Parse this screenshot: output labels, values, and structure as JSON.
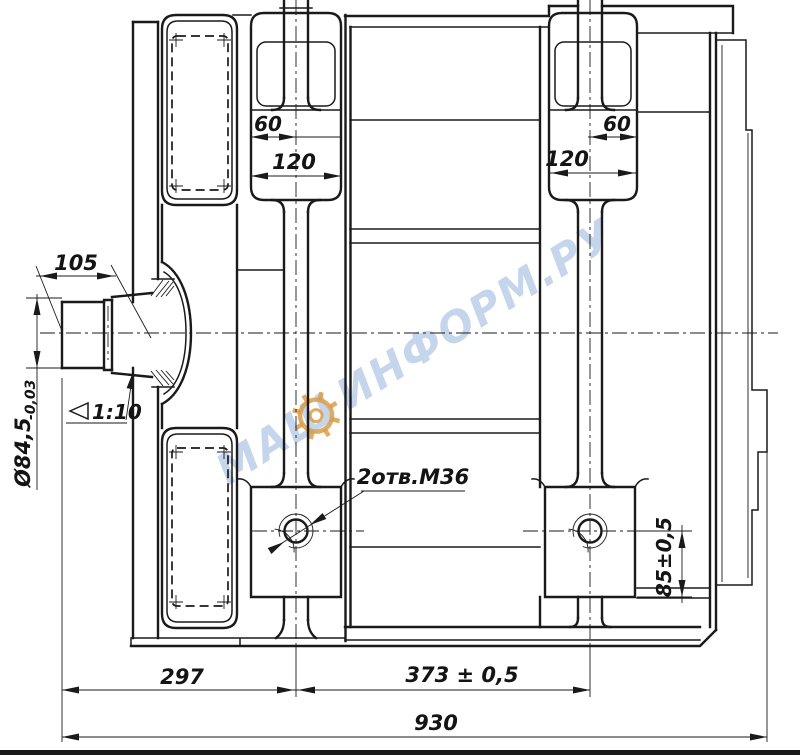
{
  "drawing": {
    "dimensions": {
      "pad_top_left_60": "60",
      "pad_top_left_120": "120",
      "pad_top_right_60": "60",
      "pad_top_right_120": "120",
      "shaft_length": "105",
      "shaft_diameter": "Ø84,5",
      "shaft_diameter_tolerance": "-0,03",
      "taper": "1:10",
      "holes_label": "2отв.М36",
      "pad_height": "85±0,5",
      "shaft_to_first_hole": "297",
      "hole_spacing": "373 ± 0,5",
      "overall_length": "930"
    },
    "watermark": {
      "left": "МАШ",
      "right": "ИНФОРМ.РУ"
    },
    "colors": {
      "line": "#1a1a1a",
      "watermark_text": "#b7cbe6",
      "watermark_gear": "#d99c4a"
    }
  }
}
